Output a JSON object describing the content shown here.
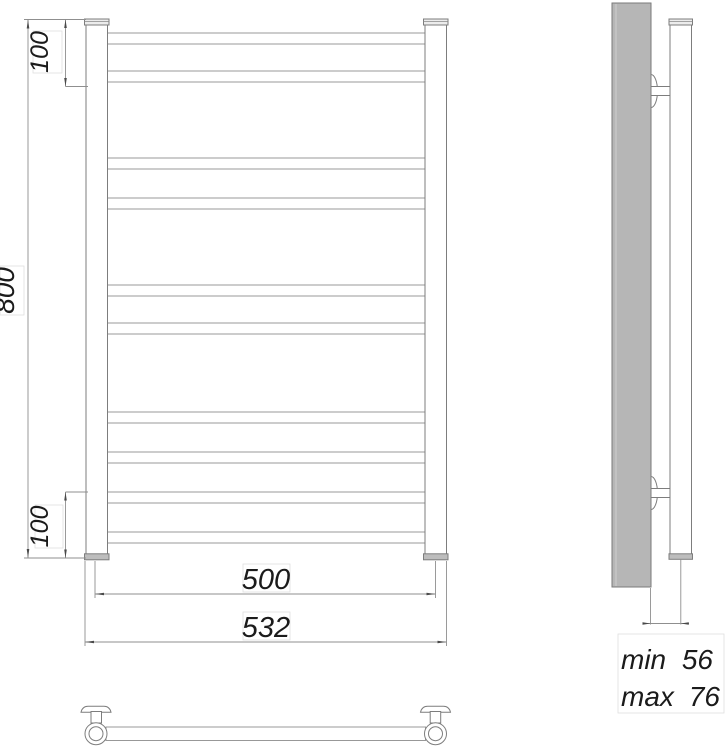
{
  "drawing": {
    "front_view": {
      "dim_height": "800",
      "dim_top_offset": "100",
      "dim_bottom_offset": "100",
      "dim_rail_span": "500",
      "dim_overall_width": "532",
      "rung_count": 10,
      "rung_groups": [
        2,
        2,
        2,
        4
      ]
    },
    "side_view": {
      "dim_depth_min_label": "min",
      "dim_depth_min_value": "56",
      "dim_depth_max_label": "max",
      "dim_depth_max_value": "76"
    },
    "colors": {
      "outline": "#7d7d7d",
      "rung_outline": "#989898",
      "dimension_line": "#8f8f8f",
      "text": "#1b1b1b",
      "wall_fill": "#b6b6b6",
      "bottom_cap_fill": "#bdbdbd",
      "background": "#ffffff"
    }
  }
}
